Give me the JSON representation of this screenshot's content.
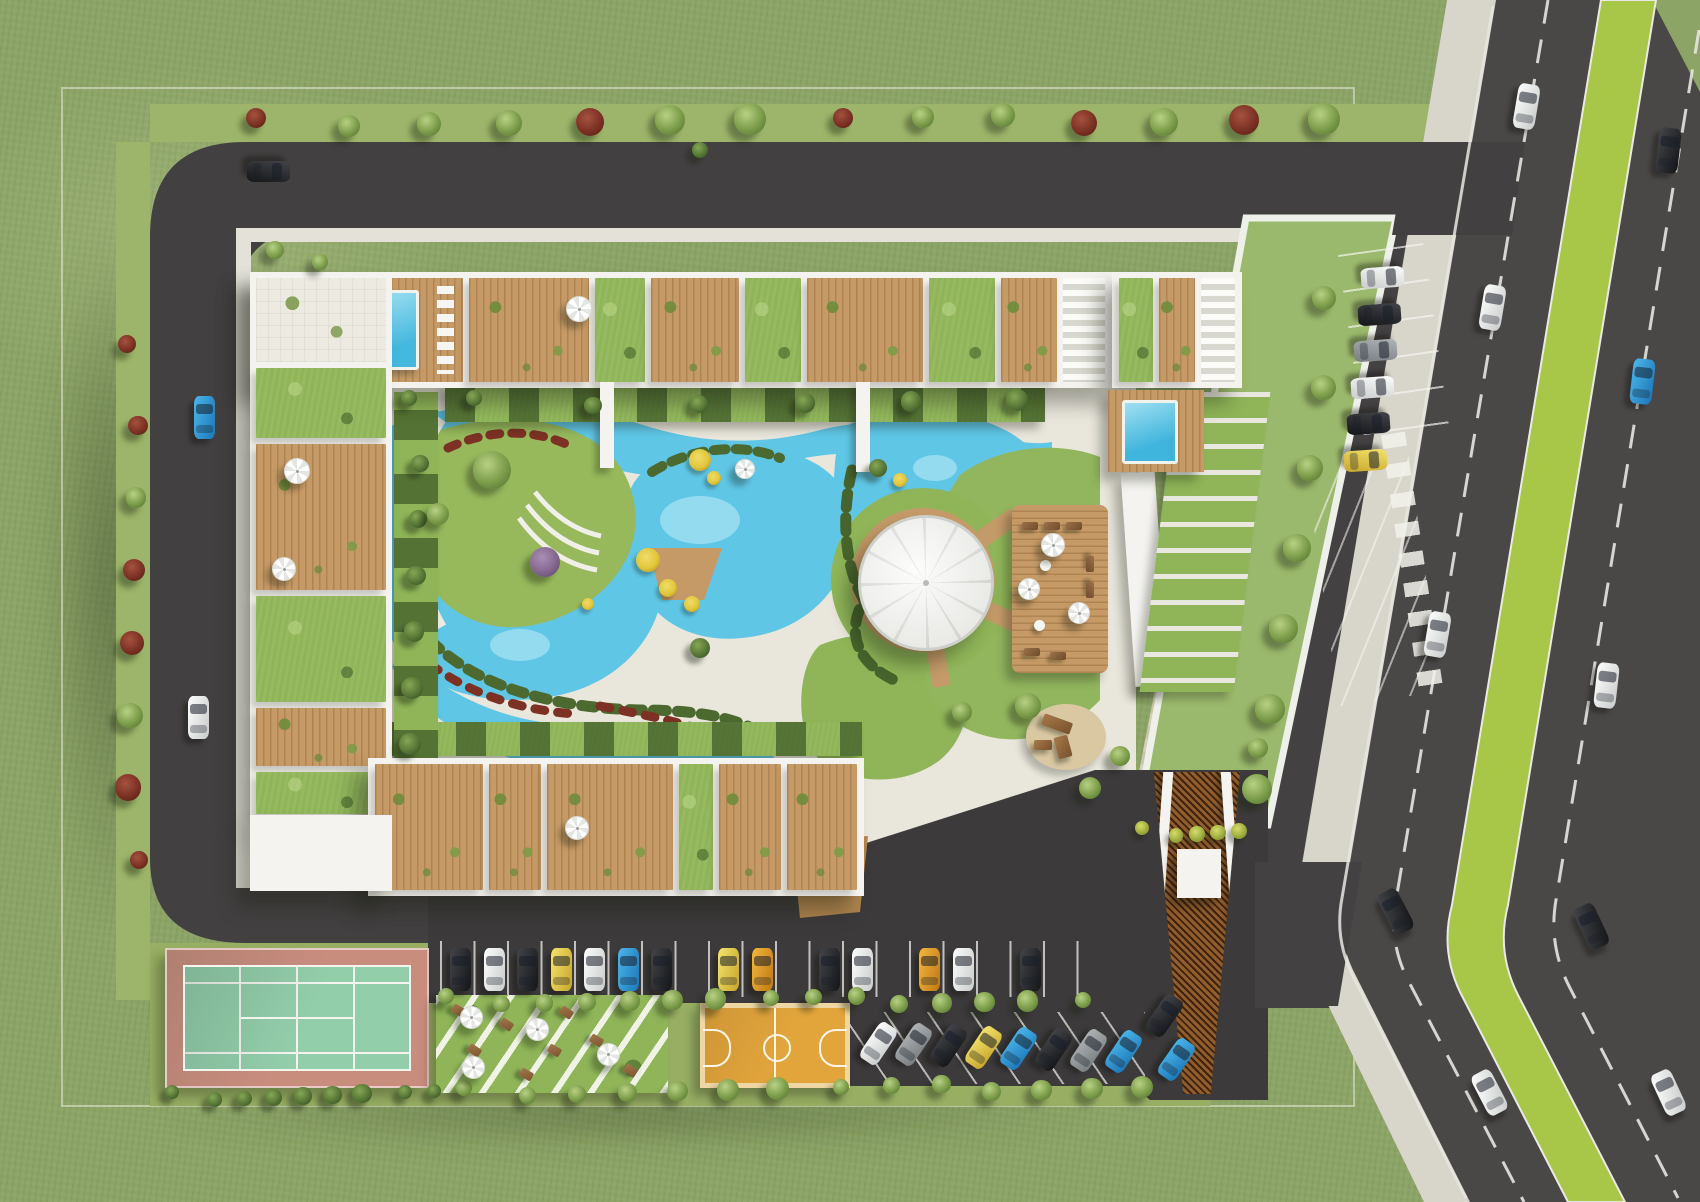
{
  "scene": {
    "type": "aerial-architectural-rendering",
    "subject": "residential complex masterplan with central lagoon pool, roof terraces, sports courts, parking and adjacent highway"
  },
  "palette": {
    "grass": "#8CA466",
    "verge": "#9DB56A",
    "lawn": "#8FB558",
    "lawn2": "#9BB96C",
    "median": "#A8C647",
    "asphalt": "#4A4747",
    "asphalt2": "#434041",
    "asphalt3": "#3C3A3B",
    "sidewalk": "#D8D5CB",
    "paving": "#E9E6DC",
    "plaza": "#D7CFBA",
    "plaza2": "#CDC4AC",
    "white": "#F4F3EF",
    "white2": "#FBFBF8",
    "wood": "#C69A66",
    "wood2": "#B0854F",
    "pool": "#5FC6E6",
    "poolL": "#A5E2F2",
    "poolD": "#2E8FB0",
    "hedge": "#4C6A2F",
    "hedgeD": "#3A5424",
    "treeL": "#B8D184",
    "tree": "#7B9C49",
    "treeD": "#4E6C2E",
    "redbush": "#7C3124",
    "redbushD": "#4F1B10",
    "flower": "#E2C63B",
    "tennisOut": "#C98D7E",
    "tennisIn": "#93CEAB",
    "court": "#E2A53C",
    "courtB": "#EFD7A4",
    "canopy": "#F6F7F4",
    "canopySeam": "#D9DBD6"
  },
  "buildings": {
    "top_cells": [
      {
        "t": "plaza",
        "w": 100
      },
      {
        "t": "pool",
        "w": 100
      },
      {
        "t": "wood",
        "w": 120
      },
      {
        "t": "green",
        "w": 50
      },
      {
        "t": "wood",
        "w": 88
      },
      {
        "t": "green",
        "w": 56
      },
      {
        "t": "wood",
        "w": 116
      },
      {
        "t": "green",
        "w": 66
      },
      {
        "t": "wood",
        "w": 56
      },
      {
        "t": "steps",
        "w": 42
      }
    ],
    "left_cells": [
      {
        "t": "plaza",
        "w": 84
      },
      {
        "t": "green",
        "w": 70
      },
      {
        "t": "wood",
        "w": 146
      },
      {
        "t": "green",
        "w": 106
      },
      {
        "t": "wood",
        "w": 58
      },
      {
        "t": "green",
        "w": 42
      }
    ],
    "bottom_cells": [
      {
        "t": "wood",
        "w": 108
      },
      {
        "t": "wood",
        "w": 52
      },
      {
        "t": "wood",
        "w": 126
      },
      {
        "t": "green",
        "w": 34
      },
      {
        "t": "wood",
        "w": 62
      },
      {
        "t": "wood",
        "w": 70
      }
    ],
    "right_cells": [
      {
        "t": "green",
        "w": 34
      },
      {
        "t": "wood",
        "w": 36
      },
      {
        "t": "steps",
        "w": 34
      }
    ]
  },
  "amenities": {
    "central_lagoon_pool": true,
    "event_canopy": true,
    "roof_terraces": true,
    "roof_pools": 2,
    "tennis_court": 1,
    "basketball_court": 1,
    "playground": 1,
    "seating_terrace": true
  },
  "parking": {
    "top_row": [
      "dark",
      "white",
      "dark",
      "yellow",
      "white",
      "blue",
      "dark",
      "",
      "yellow",
      "orange",
      "",
      "dark",
      "white",
      "",
      "orange",
      "white",
      "",
      "dark"
    ],
    "angled_row": [
      "white",
      "gray",
      "dark",
      "yellow",
      "blue",
      "dark",
      "gray",
      "blue"
    ],
    "drive_column": [
      "white",
      "dark",
      "gray",
      "white",
      "dark",
      "yellow"
    ],
    "gate_pocket": [
      "dark",
      "blue"
    ],
    "perimeter_road": [
      "blue",
      "white",
      "dark"
    ]
  },
  "highway": {
    "lanes": 2,
    "median_strip": true,
    "cars": [
      {
        "lane": "south",
        "t": 0.1,
        "c": "white"
      },
      {
        "lane": "south",
        "t": 0.26,
        "c": "white"
      },
      {
        "lane": "south",
        "t": 0.52,
        "c": "white"
      },
      {
        "lane": "south",
        "t": 0.74,
        "c": "dark"
      },
      {
        "lane": "south",
        "t": 0.9,
        "c": "white"
      },
      {
        "lane": "north",
        "t": 0.14,
        "c": "dark"
      },
      {
        "lane": "north",
        "t": 0.33,
        "c": "blue"
      },
      {
        "lane": "north",
        "t": 0.58,
        "c": "white"
      },
      {
        "lane": "north",
        "t": 0.78,
        "c": "dark"
      },
      {
        "lane": "north",
        "t": 0.93,
        "c": "white"
      }
    ]
  },
  "vegetation": {
    "top_verge": [
      "red",
      "green",
      "green",
      "green",
      "red",
      "green",
      "green",
      "red",
      "green",
      "green",
      "red",
      "green",
      "red",
      "green"
    ],
    "left_verge": [
      "red",
      "red",
      "green",
      "red",
      "red",
      "green",
      "red",
      "red"
    ],
    "hedge_top_trees": 6,
    "left_hedge_trees": 7,
    "drive_edge_trees": 7,
    "planter_bushes": 5,
    "parking_hedge_row1": 15,
    "parking_hedge_row2": 14,
    "bottom_edge_bushes": 9
  }
}
